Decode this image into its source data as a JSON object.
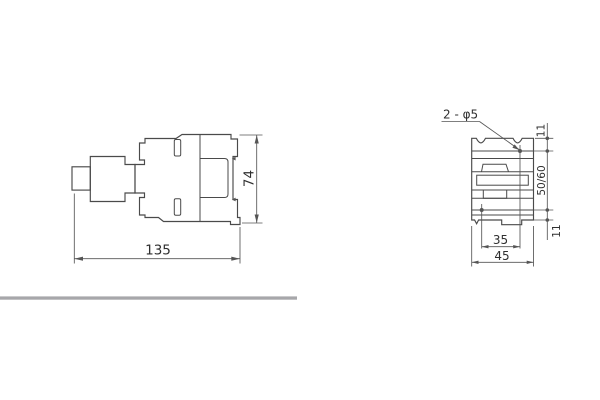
{
  "drawing": {
    "description": "Two-view technical outline drawing with mounting dimensions",
    "side_view": {
      "label_width": "135",
      "label_height": "74"
    },
    "front_view": {
      "hole_callout": "2 - φ5",
      "label_hole_spacing_horizontal": "35",
      "label_width": "45",
      "label_margin_top": "11",
      "label_margin_bottom": "11",
      "label_mounting_pitch_vertical": "50/60"
    },
    "colors": {
      "line": "#4a4a4a",
      "dim_line": "#555555",
      "text": "#2f2f2f",
      "divider": "#a7a7aa",
      "background": "#ffffff"
    }
  }
}
